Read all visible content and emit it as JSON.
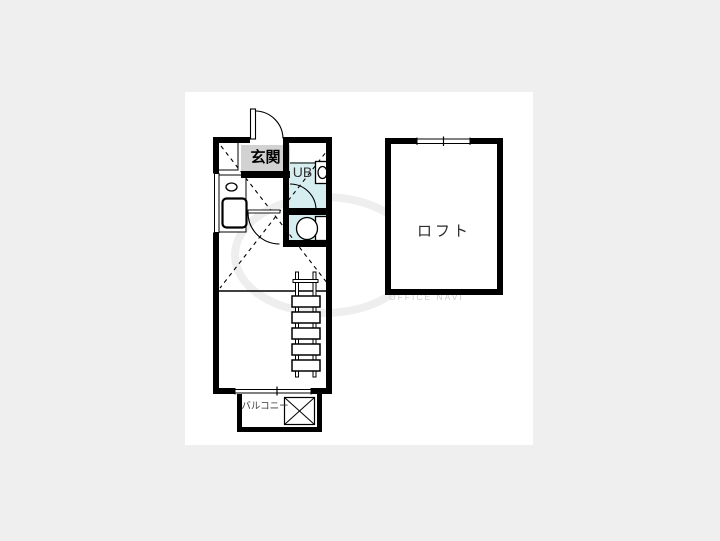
{
  "page": {
    "background_color": "#efefef",
    "panel_color": "#ffffff"
  },
  "floorplan": {
    "labels": {
      "entrance": "玄関",
      "unit_bath": "UB",
      "loft": "ロフト",
      "balcony": "バルコニー"
    },
    "colors": {
      "wall": "#000000",
      "wet_area": "#d7eef1",
      "entrance_bg": "#d2d2d2"
    },
    "watermark": "OFFICE NAVI"
  }
}
